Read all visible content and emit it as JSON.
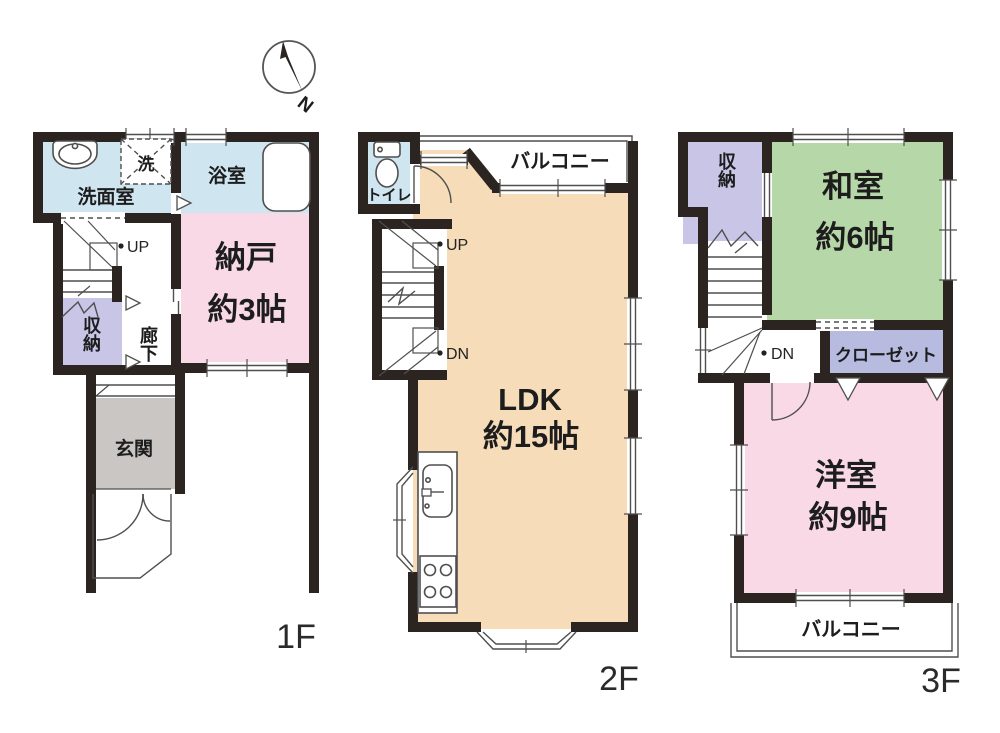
{
  "compass": {
    "north_label": "N"
  },
  "colors": {
    "wall": "#2b2421",
    "wet_blue": "#cfe6f1",
    "pink": "#fad9e7",
    "lavender": "#c8c5e7",
    "periwinkle": "#b7bbdf",
    "gray": "#c9c6c3",
    "beige": "#f6dcb8",
    "green": "#b6d7a8"
  },
  "f1": {
    "floor_label": "1F",
    "washroom": "洗面室",
    "washer": "洗",
    "bathroom": "浴室",
    "storage_room_name": "納戸",
    "storage_room_size": "約3帖",
    "stairs_up": "UP",
    "closet": "収納",
    "hallway": "廊下",
    "entrance": "玄関"
  },
  "f2": {
    "floor_label": "2F",
    "toilet": "トイレ",
    "balcony": "バルコニー",
    "stairs_up": "UP",
    "stairs_down": "DN",
    "ldk_name": "LDK",
    "ldk_size": "約15帖"
  },
  "f3": {
    "floor_label": "3F",
    "closet": "収納",
    "japanese_room_name": "和室",
    "japanese_room_size": "約6帖",
    "wardrobe": "クローゼット",
    "stairs_down": "DN",
    "western_room_name": "洋室",
    "western_room_size": "約9帖",
    "balcony": "バルコニー"
  }
}
